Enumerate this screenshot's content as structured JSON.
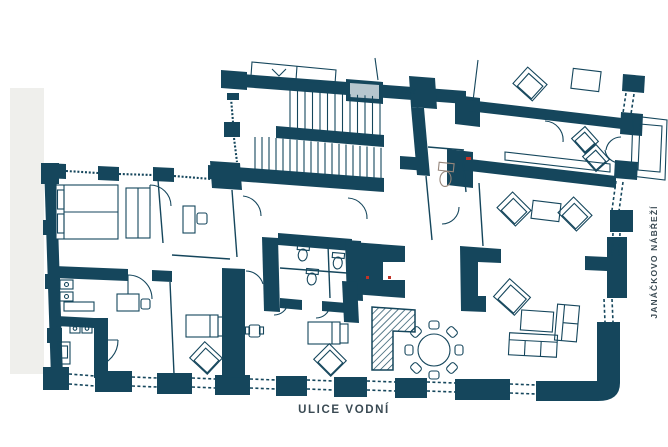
{
  "labels": {
    "street_bottom": "ULICE VODNÍ",
    "street_right": "JANÁČKOVO NÁBŘEŽÍ",
    "elevator": "VÝTAH"
  },
  "colors": {
    "wall": "#15465c",
    "background": "#ffffff",
    "street_text": "#3a4a53",
    "elevator_shaft": "#b7c6ce",
    "neighbor_building": "#efefec",
    "wc_fixture": "#96867b",
    "door_marker": "#c13327"
  },
  "elements": {
    "staircase": "double-run staircase with mid landing",
    "elevator": "elevator shaft next to staircase",
    "bathroom_cluster": "central WC/bathroom block with three toilets",
    "wc_room": "toilet room right of staircase",
    "hatched_stair": "hatched L-shaped secondary stair",
    "dining": "round table with eight chairs",
    "living": "sofa group with coffee table",
    "bedrooms": "two beds with armchairs, double bed with wardrobe",
    "offices": "desks with chairs, sanitary fixtures",
    "windows": "dashed window openings between facade piers"
  }
}
